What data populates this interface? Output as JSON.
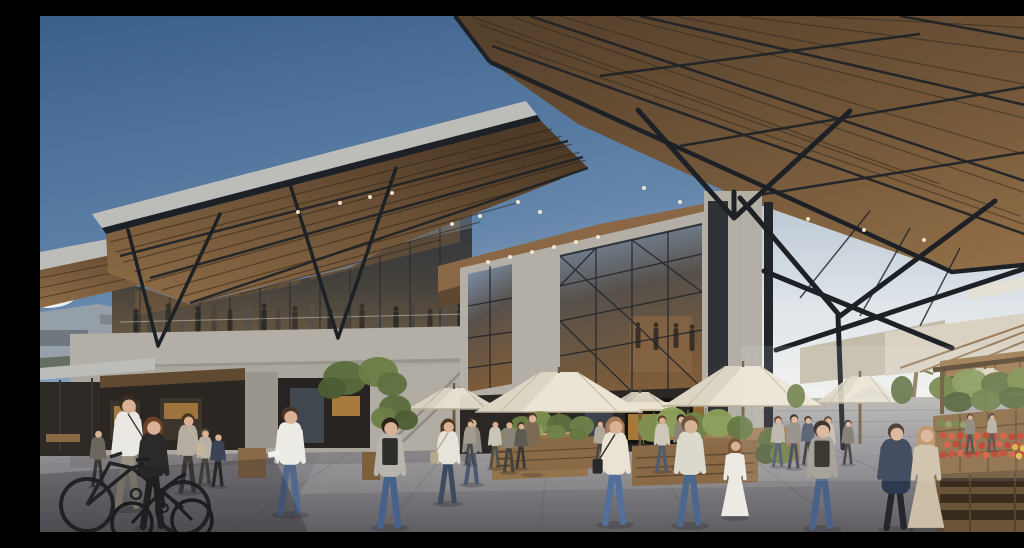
{
  "scene": {
    "title": "Timber-canopy market hall plaza",
    "description": "Photorealistic architectural rendering: a contemporary market hall with vast angular timber canopies on black steel V-struts over concrete volumes and triangulated glass facades. A glazed mezzanine terrace with visitors overlooks a stone plaza filled with pedestrians, a cyclist, parked bicycle, cream market umbrellas, timber kiosks and planters, and a produce stall with tomatoes and vegetables under white awnings beside a palm tree, beneath a blue sky."
  },
  "palette": {
    "skyTop": "#3a5f8b",
    "skyMid": "#6486ab",
    "skyLow": "#a7bbd0",
    "haze": "#e9edf0",
    "cloud": "#f5f7f8",
    "fascia": "#bcbdb8",
    "steel": "#1d2126",
    "steelSoft": "#2b3036",
    "woodLight": "#8f6d46",
    "woodMid": "#6f5438",
    "woodDark": "#4e3a26",
    "slat": "#2c2216",
    "concrete": "#b3afa6",
    "concreteShade": "#979289",
    "concreteDark": "#8c887f",
    "glassDark": "#39414c",
    "glassSky": "#7e97b3",
    "glassWarm": "#7d5c39",
    "glow": "#c08a44",
    "glowBright": "#ead9a0",
    "dark": "#26221f",
    "umbrella": "#ebe4d4",
    "umbrellaShade": "#d2c9b4",
    "awning": "#d9d2c2",
    "awningShade": "#c4bcab",
    "paveFar": "#b7b5b0",
    "paveMid": "#98969a",
    "paveNear": "#5f5e63",
    "crate": "#8a6a44",
    "pallet": "#6b5437",
    "palletSlot": "#382c1e",
    "green": "#6b7d46",
    "skin": "#d9b295",
    "shadow": "#2a2a30",
    "light": "#f7e9c8",
    "pole": "#6b5538"
  },
  "lights": {
    "left_canopy": [
      [
        258,
        196
      ],
      [
        300,
        187
      ],
      [
        330,
        181
      ],
      [
        352,
        177
      ],
      [
        412,
        208
      ],
      [
        440,
        200
      ],
      [
        478,
        186
      ],
      [
        500,
        196
      ]
    ],
    "right_canopy": [
      [
        604,
        172
      ],
      [
        640,
        186
      ],
      [
        700,
        203
      ],
      [
        768,
        203
      ],
      [
        824,
        214
      ],
      [
        884,
        224
      ]
    ],
    "soffit": [
      [
        448,
        246
      ],
      [
        470,
        241
      ],
      [
        492,
        236
      ],
      [
        514,
        231
      ],
      [
        536,
        226
      ],
      [
        558,
        221
      ]
    ]
  },
  "umbrellas": [
    {
      "cx": 414,
      "peak": 372,
      "half": 46,
      "base": 393,
      "pole": 428,
      "o": 0.92
    },
    {
      "cx": 600,
      "peak": 376,
      "half": 38,
      "base": 394,
      "pole": 426,
      "o": 0.9
    },
    {
      "cx": 820,
      "peak": 360,
      "half": 44,
      "base": 387,
      "pole": 424,
      "o": 0.9
    },
    {
      "cx": 945,
      "peak": 352,
      "half": 40,
      "base": 376,
      "pole": 410,
      "o": 0.85
    },
    {
      "cx": 519,
      "peak": 356,
      "half": 84,
      "base": 396,
      "pole": 452,
      "o": 1
    },
    {
      "cx": 703,
      "peak": 350,
      "half": 80,
      "base": 390,
      "pole": 440,
      "o": 1
    }
  ],
  "mezzanine_people": {
    "baseline": 317,
    "xs": [
      96,
      110,
      128,
      142,
      158,
      174,
      190,
      208,
      224,
      238,
      255,
      272,
      290,
      306,
      322,
      338,
      356,
      372,
      390,
      406,
      420
    ],
    "colors": [
      "#2e2a26",
      "#4a443c",
      "#37322c",
      "#55504a"
    ]
  },
  "interior_people": [
    {
      "x": 598,
      "y": 332,
      "h": 26
    },
    {
      "x": 616,
      "y": 334,
      "h": 28
    },
    {
      "x": 636,
      "y": 332,
      "h": 25
    },
    {
      "x": 652,
      "y": 335,
      "h": 27
    }
  ],
  "people_far": [
    {
      "x": 58,
      "y": 470,
      "h": 60,
      "top": "#6d665c",
      "pants": "#3a3734",
      "hair": "#2e2620"
    },
    {
      "x": 165,
      "y": 468,
      "h": 58,
      "top": "#b8b2a6",
      "pants": "#4a4642",
      "hair": "#554a3c"
    },
    {
      "x": 178,
      "y": 470,
      "h": 56,
      "top": "#3c4354",
      "pants": "#2e2b28",
      "hair": "#2e2620"
    },
    {
      "x": 148,
      "y": 476,
      "h": 82,
      "top": "#b3ada2",
      "pants": "#403c38",
      "hair": "#4a3322",
      "long": true,
      "bag": {
        "c": "#c7b598",
        "s": 1
      }
    },
    {
      "x": 408,
      "y": 487,
      "h": 88,
      "top": "#e6e3da",
      "pants": "#3d4b5e",
      "hair": "#503622",
      "long": true,
      "bag": {
        "c": "#b9a88c",
        "s": -1
      }
    },
    {
      "x": 432,
      "y": 468,
      "h": 70,
      "top": "#8f8c86",
      "pants": "#4a5a70",
      "hair": "#3a2d22"
    },
    {
      "x": 492,
      "y": 458,
      "h": 64,
      "top": "#7d6a52",
      "hair": "#4a3626",
      "variant": "torso"
    },
    {
      "x": 455,
      "y": 452,
      "h": 50,
      "top": "#c9c4b8",
      "pants": "#55504a",
      "hair": "#3a2d22"
    },
    {
      "x": 469,
      "y": 456,
      "h": 54,
      "top": "#8a8478",
      "pants": "#464240",
      "hair": "#2e2620"
    },
    {
      "x": 481,
      "y": 452,
      "h": 48,
      "top": "#5d5a52",
      "pants": "#3a3734",
      "hair": "#4a3322"
    },
    {
      "x": 430,
      "y": 448,
      "h": 46,
      "top": "#a39c8e",
      "pants": "#4c4844",
      "hair": "#3a2d22"
    },
    {
      "x": 560,
      "y": 448,
      "h": 46,
      "top": "#b0a899",
      "pants": "#4a4642",
      "hair": "#4a3322"
    },
    {
      "x": 573,
      "y": 450,
      "h": 44,
      "top": "#6b6458",
      "pants": "#3a3734",
      "hair": "#2e2620"
    },
    {
      "x": 622,
      "y": 455,
      "h": 58,
      "top": "#cfc8ba",
      "pants": "#4e5a6e",
      "hair": "#55402e"
    },
    {
      "x": 641,
      "y": 452,
      "h": 56,
      "top": "#8a8376",
      "pants": "#3c4350",
      "hair": "#2e2620"
    },
    {
      "x": 738,
      "y": 450,
      "h": 52,
      "top": "#b9b2a4",
      "pants": "#4a5568",
      "hair": "#4a3322"
    },
    {
      "x": 754,
      "y": 452,
      "h": 56,
      "top": "#8f8a80",
      "pants": "#3c4350",
      "hair": "#2e2620"
    },
    {
      "x": 768,
      "y": 448,
      "h": 50,
      "top": "#4c5568",
      "pants": "#32302e",
      "hair": "#3a2d22"
    },
    {
      "x": 788,
      "y": 452,
      "h": 54,
      "top": "#c3bcae",
      "pants": "#4a5568",
      "hair": "#55402e"
    },
    {
      "x": 808,
      "y": 448,
      "h": 46,
      "top": "#7a7468",
      "pants": "#3a3734",
      "hair": "#2e2620"
    },
    {
      "x": 930,
      "y": 436,
      "h": 40,
      "top": "#8a8478",
      "pants": "#44403c",
      "hair": "#3a2d22"
    },
    {
      "x": 952,
      "y": 434,
      "h": 38,
      "top": "#b5aea0",
      "pants": "#4a4642",
      "hair": "#2e2620"
    }
  ],
  "people_near": [
    {
      "name": "man-white-shirt",
      "x": 88,
      "y": 492,
      "h": 118,
      "top": "#eae8e2",
      "pants": "#9a9082",
      "hair": "#3a2d22",
      "bag": {
        "c": "#3a3a3a",
        "s": 1
      }
    },
    {
      "name": "woman-cyclist",
      "x": 113,
      "y": 512,
      "h": 116,
      "top": "#2b2a29",
      "pants": "#232221",
      "hair": "#6b4226",
      "long": true
    },
    {
      "name": "man-white-polo",
      "x": 250,
      "y": 498,
      "h": 112,
      "top": "#edebe5",
      "pants": "#50688c",
      "hair": "#4a3526",
      "item": true
    },
    {
      "name": "man-grey-backpack",
      "x": 350,
      "y": 511,
      "h": 114,
      "top": "#b7b4ae",
      "pants": "#47628a",
      "hair": "#2e2318",
      "pack": "#2f2d2b"
    },
    {
      "name": "woman-cream-top",
      "x": 575,
      "y": 508,
      "h": 112,
      "top": "#eae3d3",
      "pants": "#52709a",
      "hair": "#a8795a",
      "long": true,
      "bag": {
        "c": "#29282a",
        "s": -1
      }
    },
    {
      "name": "man-light-shirt",
      "x": 650,
      "y": 509,
      "h": 114,
      "top": "#dbd8ce",
      "pants": "#4c668c",
      "hair": "#6b523a"
    },
    {
      "name": "girl-white-dress",
      "x": 695,
      "y": 501,
      "h": 82,
      "top": "#edeae3",
      "hair": "#7a5638",
      "variant": "dress",
      "long": true
    },
    {
      "name": "man-black-backpack",
      "x": 782,
      "y": 512,
      "h": 112,
      "top": "#9d998f",
      "pants": "#4a6288",
      "hair": "#2c211a",
      "pack": "#26231f"
    },
    {
      "name": "man-navy-coat",
      "x": 856,
      "y": 513,
      "h": 110,
      "top": "#2e3a50",
      "pants": "#26262c",
      "hair": "#3a2e24",
      "variant": "coat"
    },
    {
      "name": "woman-beige-dress",
      "x": 886,
      "y": 513,
      "h": 108,
      "top": "#cdbfa7",
      "hair": "#b98f63",
      "variant": "dress",
      "long": true
    }
  ],
  "foliage": [
    {
      "cx": 305,
      "cy": 362,
      "rx": 22,
      "ry": 17,
      "c": "#5a6b3c"
    },
    {
      "cx": 338,
      "cy": 356,
      "rx": 20,
      "ry": 15,
      "c": "#6b7d46"
    },
    {
      "cx": 292,
      "cy": 372,
      "rx": 14,
      "ry": 11,
      "c": "#4e5e34"
    },
    {
      "cx": 352,
      "cy": 368,
      "rx": 15,
      "ry": 12,
      "c": "#5f7040"
    },
    {
      "cx": 355,
      "cy": 392,
      "rx": 16,
      "ry": 13,
      "c": "#5a6b3c"
    },
    {
      "cx": 344,
      "cy": 402,
      "rx": 13,
      "ry": 11,
      "c": "#6b7d46"
    },
    {
      "cx": 366,
      "cy": 404,
      "rx": 12,
      "ry": 10,
      "c": "#4e5e34"
    },
    {
      "cx": 732,
      "cy": 424,
      "rx": 14,
      "ry": 12,
      "c": "#5f7040"
    },
    {
      "cx": 726,
      "cy": 438,
      "rx": 11,
      "ry": 10,
      "c": "#50603a"
    },
    {
      "cx": 742,
      "cy": 438,
      "rx": 12,
      "ry": 10,
      "c": "#6b7d46"
    },
    {
      "cx": 612,
      "cy": 412,
      "rx": 14,
      "ry": 14,
      "c": "#7d9050"
    },
    {
      "cx": 632,
      "cy": 406,
      "rx": 16,
      "ry": 15,
      "c": "#8da05c"
    },
    {
      "cx": 655,
      "cy": 410,
      "rx": 15,
      "ry": 14,
      "c": "#70834a"
    },
    {
      "cx": 678,
      "cy": 407,
      "rx": 16,
      "ry": 14,
      "c": "#8da05c"
    },
    {
      "cx": 700,
      "cy": 412,
      "rx": 13,
      "ry": 12,
      "c": "#657944"
    },
    {
      "cx": 482,
      "cy": 410,
      "rx": 12,
      "ry": 10,
      "c": "#6b7d46"
    },
    {
      "cx": 500,
      "cy": 406,
      "rx": 13,
      "ry": 11,
      "c": "#7d9050"
    },
    {
      "cx": 520,
      "cy": 408,
      "rx": 13,
      "ry": 10,
      "c": "#5f7040"
    },
    {
      "cx": 542,
      "cy": 410,
      "rx": 12,
      "ry": 10,
      "c": "#70834a"
    },
    {
      "cx": 470,
      "cy": 418,
      "rx": 10,
      "ry": 7,
      "c": "#7d9050"
    },
    {
      "cx": 492,
      "cy": 415,
      "rx": 11,
      "ry": 8,
      "c": "#8da05c"
    },
    {
      "cx": 516,
      "cy": 416,
      "rx": 10,
      "ry": 7,
      "c": "#70834a"
    },
    {
      "cx": 538,
      "cy": 418,
      "rx": 9,
      "ry": 6,
      "c": "#647841"
    },
    {
      "cx": 905,
      "cy": 372,
      "rx": 16,
      "ry": 12,
      "c": "#6f8142"
    },
    {
      "cx": 930,
      "cy": 366,
      "rx": 18,
      "ry": 13,
      "c": "#86995a"
    },
    {
      "cx": 958,
      "cy": 368,
      "rx": 17,
      "ry": 12,
      "c": "#5f7040"
    },
    {
      "cx": 985,
      "cy": 364,
      "rx": 18,
      "ry": 13,
      "c": "#7d9050"
    },
    {
      "cx": 1010,
      "cy": 368,
      "rx": 16,
      "ry": 12,
      "c": "#86995a"
    },
    {
      "cx": 918,
      "cy": 386,
      "rx": 15,
      "ry": 10,
      "c": "#4e5e34"
    },
    {
      "cx": 946,
      "cy": 384,
      "rx": 16,
      "ry": 11,
      "c": "#6b7d46"
    },
    {
      "cx": 975,
      "cy": 382,
      "rx": 16,
      "ry": 11,
      "c": "#5a6b3c"
    },
    {
      "cx": 1004,
      "cy": 384,
      "rx": 15,
      "ry": 10,
      "c": "#70834a"
    },
    {
      "cx": 756,
      "cy": 380,
      "rx": 9,
      "ry": 12,
      "c": "#6b7d46"
    },
    {
      "cx": 862,
      "cy": 374,
      "rx": 11,
      "ry": 14,
      "c": "#5f7040"
    }
  ],
  "produce_grids": [
    {
      "x0": 903,
      "y0": 420,
      "cols": 14,
      "rows": 3,
      "dx": 8.6,
      "dy": 9,
      "r": 3.4,
      "colors": [
        "#c5432c",
        "#d4583a",
        "#b93a24"
      ]
    },
    {
      "x0": 975,
      "y0": 432,
      "cols": 6,
      "rows": 2,
      "dx": 8,
      "dy": 8,
      "r": 3.2,
      "colors": [
        "#dfa93c",
        "#e6b84e"
      ]
    },
    {
      "x0": 901,
      "y0": 408,
      "cols": 5,
      "rows": 1,
      "dx": 7.5,
      "dy": 0,
      "r": 3.6,
      "colors": [
        "#6f8142",
        "#86995a"
      ]
    }
  ]
}
